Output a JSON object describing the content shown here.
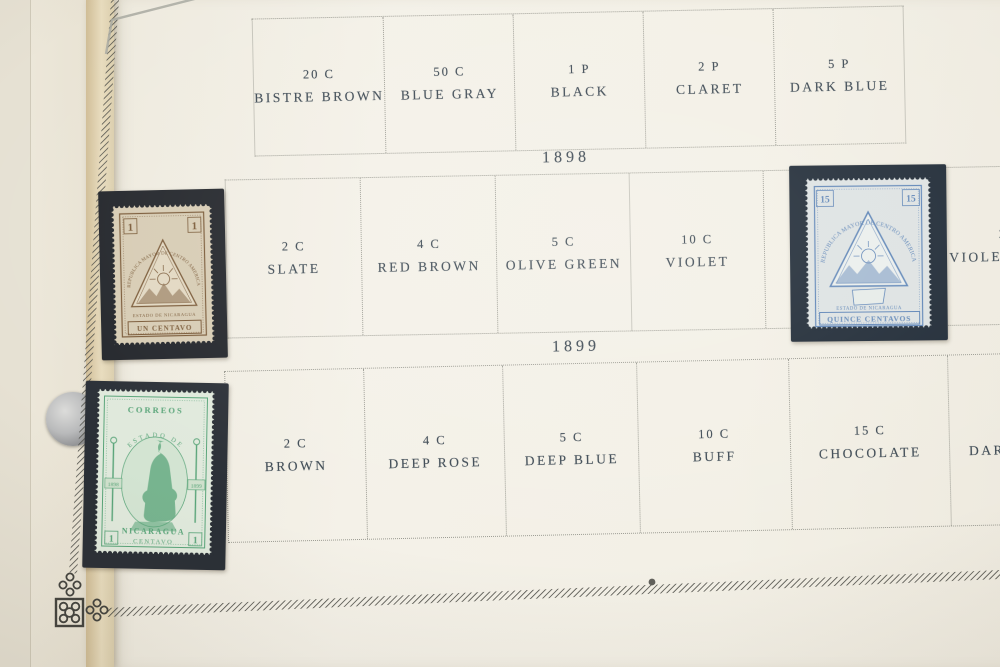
{
  "album": {
    "top_year": "1897",
    "year_1898": "1898",
    "year_1899": "1899",
    "top_row_cells": [
      {
        "value": "20 C",
        "color": "BISTRE BROWN"
      },
      {
        "value": "50 C",
        "color": "BLUE GRAY"
      },
      {
        "value": "1 P",
        "color": "BLACK"
      },
      {
        "value": "2 P",
        "color": "CLARET"
      },
      {
        "value": "5 P",
        "color": "DARK BLUE"
      }
    ],
    "row_1898_cells": [
      {
        "value": "2 C",
        "color": "SLATE"
      },
      {
        "value": "4 C",
        "color": "RED BROWN"
      },
      {
        "value": "5 C",
        "color": "OLIVE GREEN"
      },
      {
        "value": "10 C",
        "color": "VIOLET"
      },
      {
        "value": "",
        "color": ""
      },
      {
        "value": "20 C",
        "color": "VIOLET BROWN"
      }
    ],
    "row_1899_cells": [
      {
        "value": "2 C",
        "color": "BROWN"
      },
      {
        "value": "4 C",
        "color": "DEEP ROSE"
      },
      {
        "value": "5 C",
        "color": "DEEP BLUE"
      },
      {
        "value": "10 C",
        "color": "BUFF"
      },
      {
        "value": "15 C",
        "color": "CHOCOLATE"
      },
      {
        "value": "20 C",
        "color": "DARK VIOLET"
      }
    ],
    "stamps": {
      "brown_1c": {
        "denomination": "1",
        "arc_text": "REPUBLICA MAYOR DE CENTRO AMERICA",
        "banner_text": "ESTADO DE NICARAGUA",
        "value_text": "UN CENTAVO",
        "ink_color": "#7a5a38",
        "paper_color": "#d7ccb4",
        "mount_color": "#23262b"
      },
      "blue_15c": {
        "denomination": "15",
        "arc_text": "REPUBLICA MAYOR DE CENTRO AMERICA",
        "banner_text": "ESTADO DE NICARAGUA",
        "value_text": "QUINCE CENTAVOS",
        "ink_color": "#5d84b6",
        "paper_color": "#dde2e2",
        "mount_color": "#1d2834"
      },
      "green_1c": {
        "denomination": "1",
        "top_text": "CORREOS",
        "arc_text": "ESTADO DE",
        "year_left": "1898",
        "year_right": "1899",
        "country_text": "NICARAGUA",
        "value_text": "CENTAVO",
        "ink_color": "#58a478",
        "paper_color": "#e0e9dc",
        "mount_color": "#2a2f36"
      }
    }
  }
}
